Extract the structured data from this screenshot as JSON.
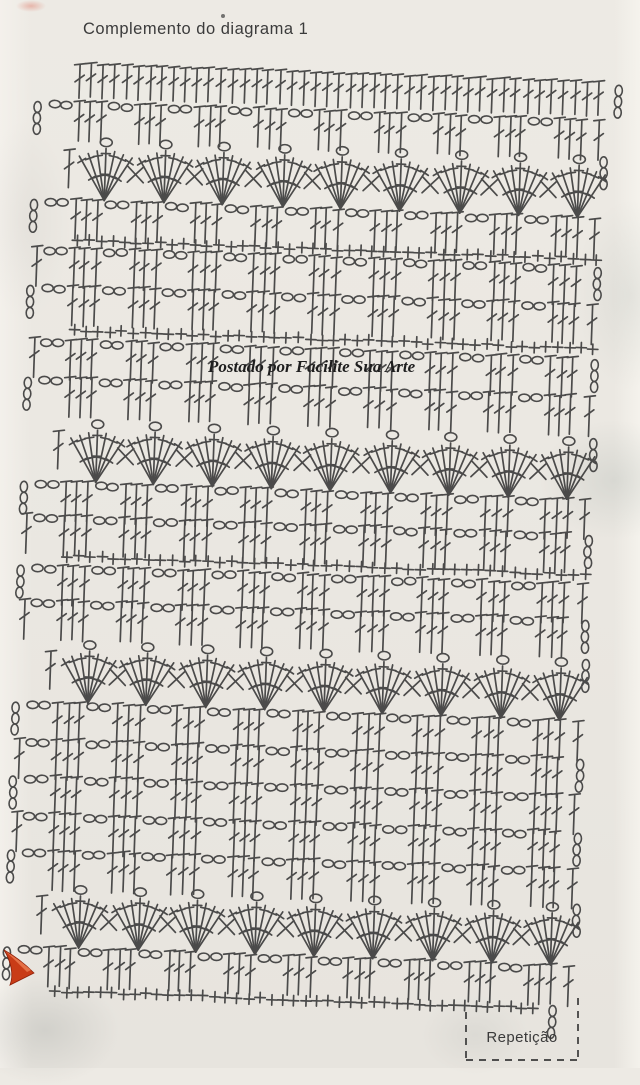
{
  "header": {
    "title": "Complemento do diagrama 1"
  },
  "watermark": {
    "text": "Postado por Facilite Sua Arte"
  },
  "repetition": {
    "label": "Repetição"
  },
  "colors": {
    "ink": "#3a3a3a",
    "paper": "#ebe8e2",
    "arrow": "#c93c17",
    "arrow_highlight": "#ea7a50",
    "watermark": "#1e1e1e"
  },
  "symbols": {
    "dc": "double-crochet-stitch",
    "sc": "single-crochet-stitch",
    "ch": "chain-stitch",
    "fan": "shell-fan-motif"
  },
  "diagram": {
    "skew_deg": 2.05,
    "pivot_x": 40,
    "pivot_y": 62,
    "bracket": {
      "x1": 466,
      "x2": 578,
      "top_left": 1012,
      "top_right": 998,
      "bottom": 1060
    },
    "arrow": {
      "body": "M4,950 C15,956 25,964 34,973 L10,985 C14,975 11,961 4,950 Z",
      "highlight": "M5,951 C15,957 24,964 31,970 L27,972 C19,964 12,957 5,951 Z"
    },
    "rows": [
      {
        "type": "dc",
        "y": 62,
        "x0": 80,
        "pitch": 11.8,
        "count": 45
      },
      {
        "type": "cluster",
        "y": 99,
        "x0": 50,
        "pitch": 60,
        "groups": 9,
        "edge": "ch"
      },
      {
        "type": "fan",
        "y": 136,
        "x0": 110,
        "pitch": 59,
        "count": 9
      },
      {
        "type": "cluster",
        "y": 197,
        "x0": 50,
        "pitch": 60,
        "groups": 9,
        "edge": "ch"
      },
      {
        "type": "sc",
        "y": 231,
        "x0": 84,
        "pitch": 11.8,
        "count": 45
      },
      {
        "type": "cluster",
        "y": 245,
        "x0": 50,
        "pitch": 60,
        "groups": 9,
        "edge": "dc"
      },
      {
        "type": "cluster",
        "y": 283,
        "x0": 50,
        "pitch": 60,
        "groups": 9,
        "edge": "ch"
      },
      {
        "type": "sc",
        "y": 321,
        "x0": 84,
        "pitch": 11.8,
        "count": 45
      },
      {
        "type": "cluster",
        "y": 337,
        "x0": 50,
        "pitch": 60,
        "groups": 9,
        "edge": "dc"
      },
      {
        "type": "cluster",
        "y": 375,
        "x0": 50,
        "pitch": 60,
        "groups": 9,
        "edge": "ch"
      },
      {
        "type": "fan",
        "y": 418,
        "x0": 110,
        "pitch": 59,
        "count": 9
      },
      {
        "type": "cluster",
        "y": 479,
        "x0": 50,
        "pitch": 60,
        "groups": 9,
        "edge": "ch"
      },
      {
        "type": "cluster",
        "y": 513,
        "x0": 50,
        "pitch": 60,
        "groups": 9,
        "edge": "dc"
      },
      {
        "type": "sc",
        "y": 547,
        "x0": 84,
        "pitch": 11.8,
        "count": 45
      },
      {
        "type": "cluster",
        "y": 563,
        "x0": 50,
        "pitch": 60,
        "groups": 9,
        "edge": "ch"
      },
      {
        "type": "cluster",
        "y": 598,
        "x0": 50,
        "pitch": 60,
        "groups": 9,
        "edge": "dc"
      },
      {
        "type": "fan",
        "y": 639,
        "x0": 110,
        "pitch": 59,
        "count": 9
      },
      {
        "type": "cluster",
        "y": 700,
        "x0": 50,
        "pitch": 60,
        "groups": 9,
        "edge": "ch"
      },
      {
        "type": "cluster",
        "y": 737,
        "x0": 50,
        "pitch": 60,
        "groups": 9,
        "edge": "dc"
      },
      {
        "type": "cluster",
        "y": 774,
        "x0": 50,
        "pitch": 60,
        "groups": 9,
        "edge": "ch"
      },
      {
        "type": "cluster",
        "y": 811,
        "x0": 50,
        "pitch": 60,
        "groups": 9,
        "edge": "dc"
      },
      {
        "type": "cluster",
        "y": 848,
        "x0": 50,
        "pitch": 60,
        "groups": 9,
        "edge": "ch"
      },
      {
        "type": "fan",
        "y": 884,
        "x0": 110,
        "pitch": 59,
        "count": 9
      },
      {
        "type": "cluster",
        "y": 945,
        "x0": 50,
        "pitch": 60,
        "groups": 9,
        "edge": "ch"
      },
      {
        "type": "sc",
        "y": 982,
        "x0": 88,
        "pitch": 11.4,
        "count": 43,
        "right_chains": true
      }
    ]
  }
}
